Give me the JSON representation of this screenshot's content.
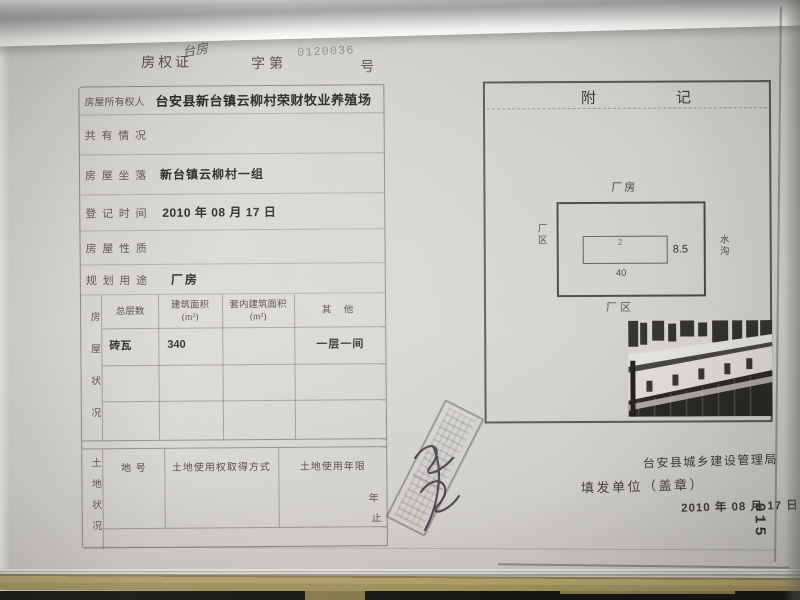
{
  "certificate": {
    "doc_type": "房权证",
    "handwritten": "台房",
    "zi_di": "字第",
    "serial": "0120036",
    "hao": "号"
  },
  "info_rows": [
    {
      "label": "房屋所有权人",
      "value": "台安县新台镇云柳村荣财牧业养殖场"
    },
    {
      "label": "共 有 情 况",
      "value": ""
    },
    {
      "label": "房 屋 坐 落",
      "value": "新台镇云柳村一组"
    },
    {
      "label": "登 记 时 间",
      "value": "2010 年 08 月 17 日"
    },
    {
      "label": "房 屋 性 质",
      "value": ""
    },
    {
      "label": "规 划 用 途",
      "value": "厂房"
    }
  ],
  "house_status": {
    "side_label": "房屋状况",
    "headers": [
      "总层数",
      "建筑面积\n(m²)",
      "套内建筑面积\n(m²)",
      "其 他"
    ],
    "row": [
      "砖瓦",
      "340",
      "",
      "一层一间"
    ]
  },
  "land_status": {
    "side_label": "土地状况",
    "headers": [
      "地 号",
      "土地使用权取得方式",
      "土地使用年限"
    ],
    "year": "年",
    "zhi": "止"
  },
  "annex": {
    "title": "附记",
    "diagram": {
      "top_label": "厂房",
      "left_label": "厂区",
      "right_label": "水沟",
      "bottom_label": "厂区",
      "unit_number": "2",
      "width_label": "40",
      "height_label": "8.5"
    },
    "issuer": "台安县城乡建设管理局",
    "issue_label": "填发单位（盖章）",
    "date": "2010 年 08 月 17 日",
    "page_no": "015"
  }
}
